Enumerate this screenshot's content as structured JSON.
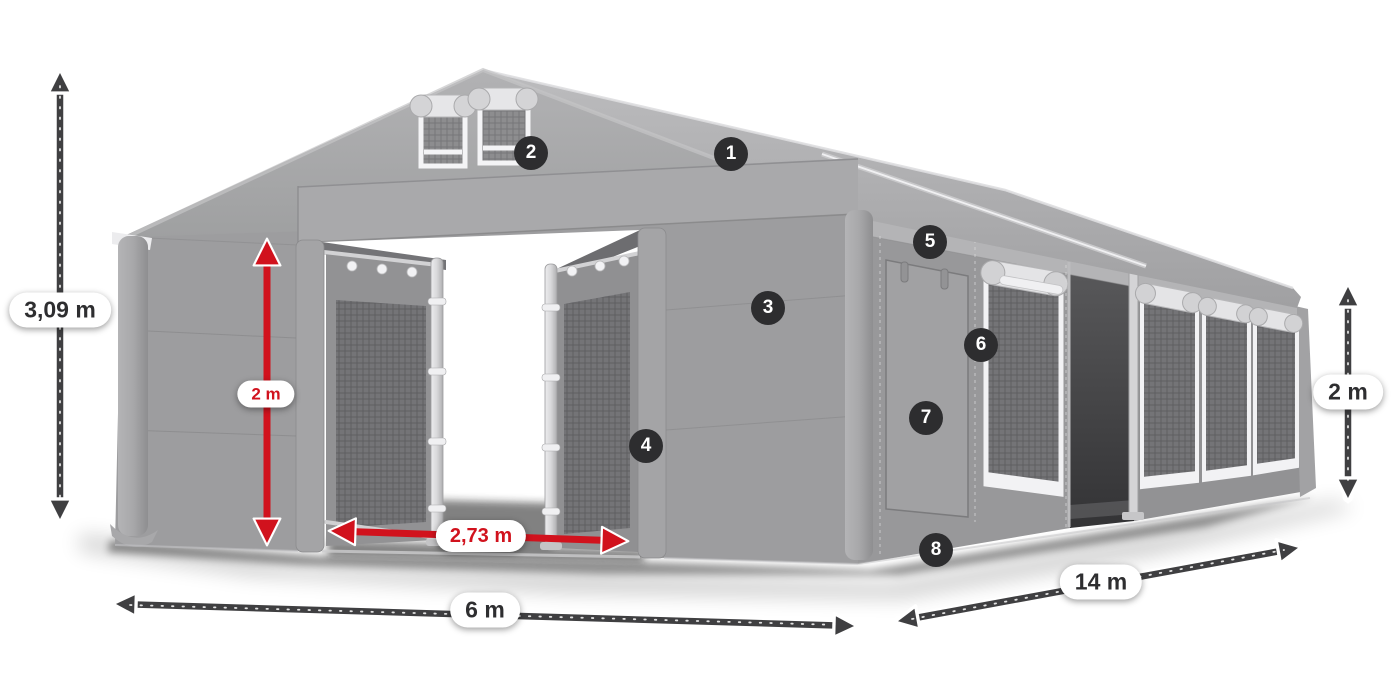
{
  "badges": [
    {
      "number": "1"
    },
    {
      "number": "2"
    },
    {
      "number": "3"
    },
    {
      "number": "4"
    },
    {
      "number": "5"
    },
    {
      "number": "6"
    },
    {
      "number": "7"
    },
    {
      "number": "8"
    }
  ],
  "dimensions": {
    "total_height": {
      "value": "3,09 m"
    },
    "door_height": {
      "value": "2 m"
    },
    "door_width": {
      "value": "2,73 m"
    },
    "front_width": {
      "value": "6 m"
    },
    "side_length": {
      "value": "14 m"
    },
    "side_wall_height": {
      "value": "2 m"
    }
  },
  "colors": {
    "arrow_dark": "#3f3f41",
    "arrow_red": "#d1121d",
    "badge_background": "#2d2d2f",
    "badge_number": "#ffffff",
    "label_background": "#ffffff",
    "label_text_dark": "#2e2e30",
    "label_text_red": "#d1121d",
    "tent_canvas": "#9d9d9f",
    "tent_roof": "#b2b2b4",
    "tent_interior_dark": "#4e4e50",
    "trim_white": "#f2f2f4",
    "tie_orange": "#dd5f3d"
  }
}
